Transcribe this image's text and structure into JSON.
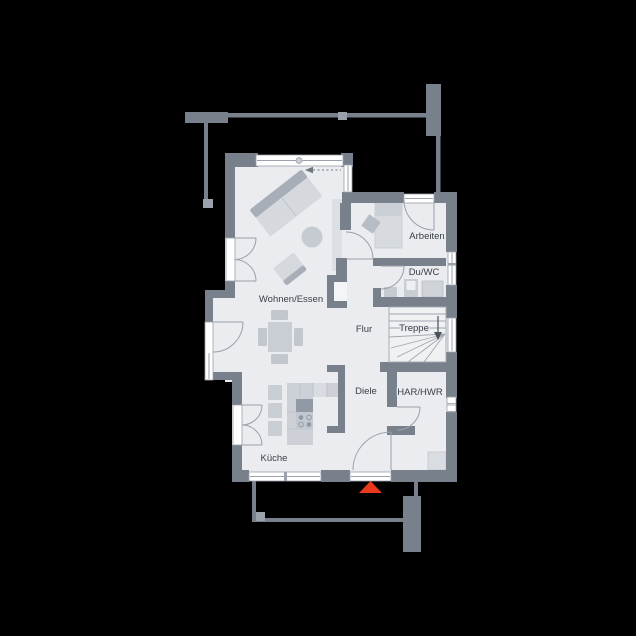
{
  "plan": {
    "title": "Erdgeschoss Grundriss",
    "rooms": [
      {
        "id": "wohnen-essen",
        "label": "Wohnen/Essen"
      },
      {
        "id": "arbeiten",
        "label": "Arbeiten"
      },
      {
        "id": "du-wc",
        "label": "Du/WC"
      },
      {
        "id": "flur",
        "label": "Flur"
      },
      {
        "id": "treppe",
        "label": "Treppe"
      },
      {
        "id": "diele",
        "label": "Diele"
      },
      {
        "id": "har-hwr",
        "label": "HAR/HWR"
      },
      {
        "id": "kueche",
        "label": "Küche"
      }
    ],
    "markers": [
      {
        "id": "entrance-marker",
        "shape": "triangle-up",
        "color": "#E8391A"
      },
      {
        "id": "stair-direction-arrow",
        "shape": "arrow-down"
      },
      {
        "id": "sliding-door-arrow",
        "shape": "dashed-arrow-left"
      }
    ],
    "fixtures": [
      "sofa",
      "coffee-table",
      "armchair",
      "dining-table",
      "dining-chairs",
      "sideboard",
      "daybed",
      "desk-chair",
      "washbasin",
      "wc",
      "shower",
      "kitchen-counter",
      "stove",
      "kitchen-island",
      "appliance",
      "meter-boxes"
    ],
    "colors": {
      "background": "#000000",
      "wall": "#78808C",
      "floor": "#EAECEF",
      "floor_bright": "#EFF1F3",
      "window": "#FFFFFF",
      "furniture": "#CDD1D7",
      "furniture_dark": "#A7AEB8",
      "line": "#9AA1AA",
      "text": "#3A4048",
      "accent": "#E8391A"
    }
  }
}
